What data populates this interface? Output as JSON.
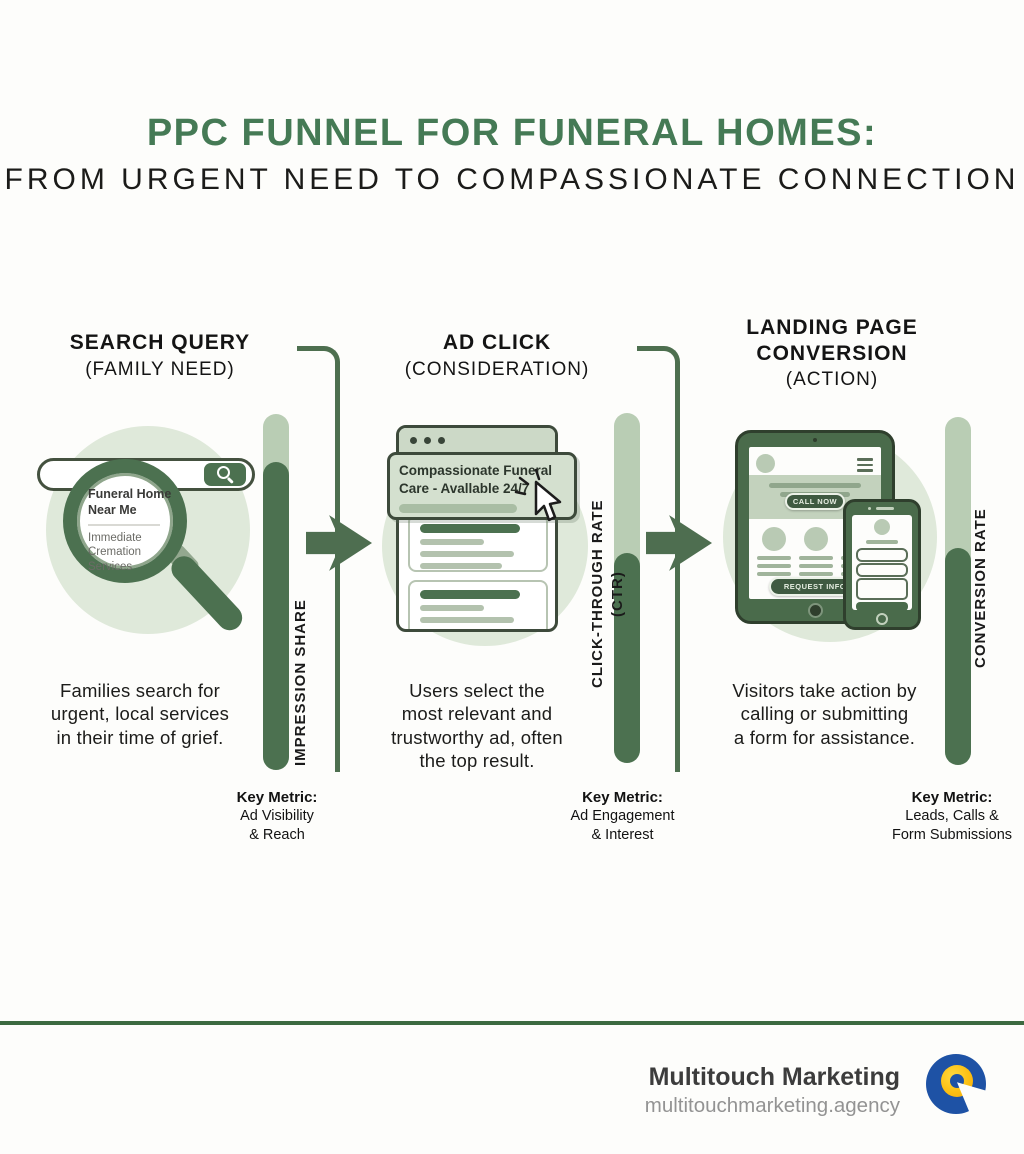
{
  "title": {
    "line1": "PPC FUNNEL FOR FUNERAL HOMES:",
    "line2": "FROM URGENT NEED TO COMPASSIONATE CONNECTION"
  },
  "stages": [
    {
      "heading": "SEARCH QUERY",
      "subheading": "(FAMILY NEED)",
      "description": "Families search for\nurgent, local services\nin their time of grief.",
      "metric_bar_label": "IMPRESSION SHARE",
      "key_metric": {
        "title": "Key Metric:",
        "detail": "Ad Visibility\n& Reach"
      }
    },
    {
      "heading": "AD CLICK",
      "subheading": "(CONSIDERATION)",
      "description": "Users select the\nmost relevant and\ntrustworthy ad, often\nthe top result.",
      "metric_bar_label": "CLICK-THROUGH RATE (CTR)",
      "key_metric": {
        "title": "Key Metric:",
        "detail": "Ad Engagement\n& Interest"
      }
    },
    {
      "heading": "LANDING PAGE\nCONVERSION",
      "subheading": "(ACTION)",
      "description": "Visitors take action by\ncalling or submitting\na form for assistance.",
      "metric_bar_label": "CONVERSION RATE",
      "key_metric": {
        "title": "Key Metric:",
        "detail": "Leads, Calls &\nForm Submissions"
      }
    }
  ],
  "search_illustration": {
    "query_bold": "Funeral Home\nNear Me",
    "query_secondary": "Immediate\nCremation\nServices"
  },
  "ad_illustration": {
    "ad_text": "Compassionate Funeral\nCare - Avallable 24/7"
  },
  "landing_illustration": {
    "call_button": "CALL NOW",
    "request_button": "REQUEST INFO"
  },
  "footer": {
    "brand": "Multitouch Marketing",
    "website": "multitouchmarketing.agency"
  },
  "colors": {
    "title_green": "#457a55",
    "dark_green": "#4c7150",
    "bar_light_green": "#b9cdb4",
    "circle_bg_green": "#dfe9da",
    "divider_green": "#3c6a40",
    "logo_blue": "#1e52a5",
    "logo_yellow": "#fcc013"
  }
}
